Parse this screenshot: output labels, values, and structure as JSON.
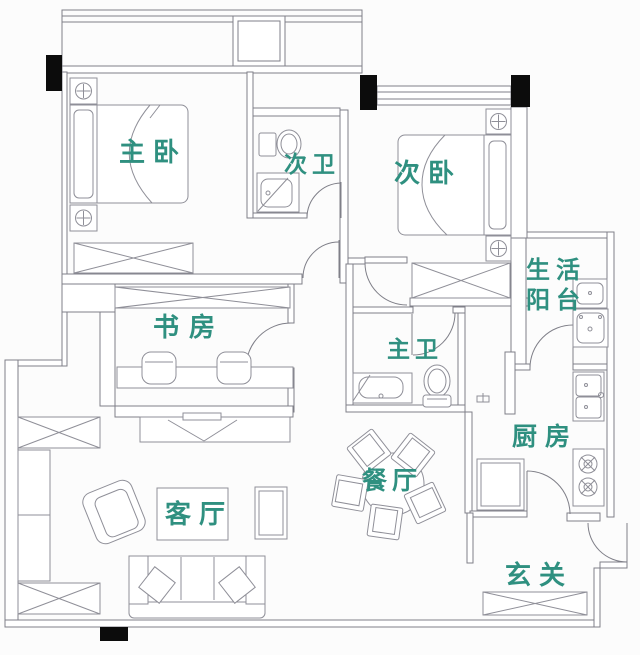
{
  "floorplan": {
    "background_color": "#fcfcfc",
    "wall_color": "#7f7f88",
    "furniture_color": "#8f8f98",
    "label_color": "#2f9080",
    "column_color": "#0c0c0c",
    "rooms": [
      {
        "id": "master-bedroom",
        "label": "主卧"
      },
      {
        "id": "second-bathroom",
        "label": "次卫"
      },
      {
        "id": "second-bedroom",
        "label": "次卧"
      },
      {
        "id": "utility-balcony",
        "label": "生活阳台",
        "label_line1": "生活",
        "label_line2": "阳台"
      },
      {
        "id": "study",
        "label": "书房"
      },
      {
        "id": "master-bathroom",
        "label": "主卫"
      },
      {
        "id": "kitchen",
        "label": "厨房"
      },
      {
        "id": "dining-room",
        "label": "餐厅"
      },
      {
        "id": "living-room",
        "label": "客厅"
      },
      {
        "id": "entryway",
        "label": "玄关"
      }
    ],
    "furniture": [
      "double-bed",
      "nightstand",
      "wardrobe",
      "toilet",
      "wash-basin",
      "washing-machine",
      "kitchen-sink",
      "gas-stove",
      "refrigerator",
      "round-dining-table",
      "dining-chair",
      "desk",
      "desk-chair",
      "tv",
      "tv-stand",
      "sofa",
      "armchair",
      "coffee-table",
      "side-table",
      "shoe-cabinet",
      "bay-window",
      "flue-box"
    ]
  }
}
